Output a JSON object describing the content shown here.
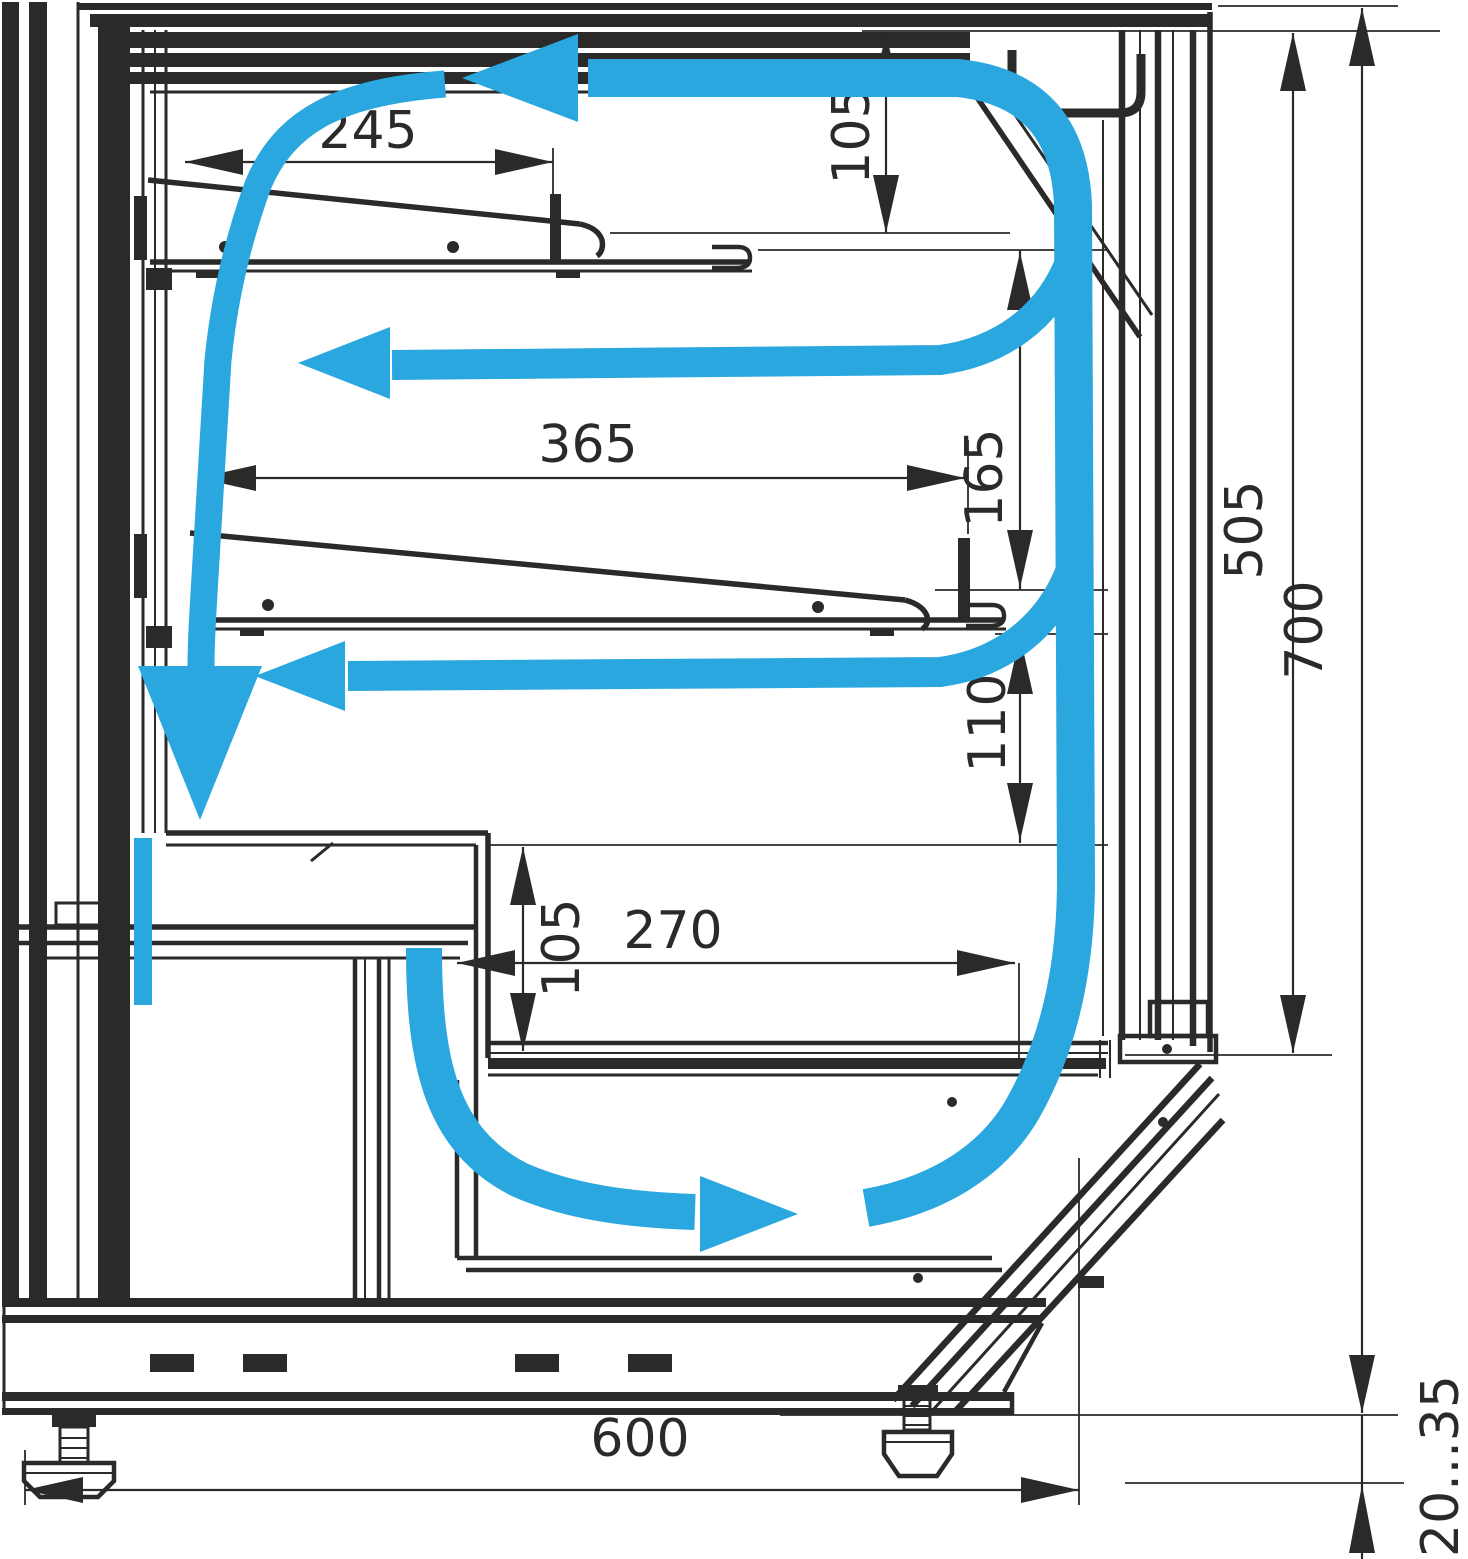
{
  "drawing": {
    "title": "Refrigerated display case cross-section with air circulation",
    "type": "technical-diagram",
    "units": "mm",
    "colors": {
      "line": "#2b2a29",
      "airflow": "#2aa7df",
      "background": "#ffffff"
    },
    "dims": {
      "shelf_top_depth": {
        "label": "245"
      },
      "top_clearance": {
        "label": "105"
      },
      "shelf_mid_depth": {
        "label": "365"
      },
      "gap_upper": {
        "label": "165"
      },
      "inner_height": {
        "label": "505"
      },
      "overall_height": {
        "label": "700"
      },
      "gap_lower": {
        "label": "110"
      },
      "well_height": {
        "label": "105"
      },
      "well_depth": {
        "label": "270"
      },
      "overall_depth": {
        "label": "600"
      },
      "leg_adjust_range": {
        "label": "20...35"
      }
    }
  }
}
